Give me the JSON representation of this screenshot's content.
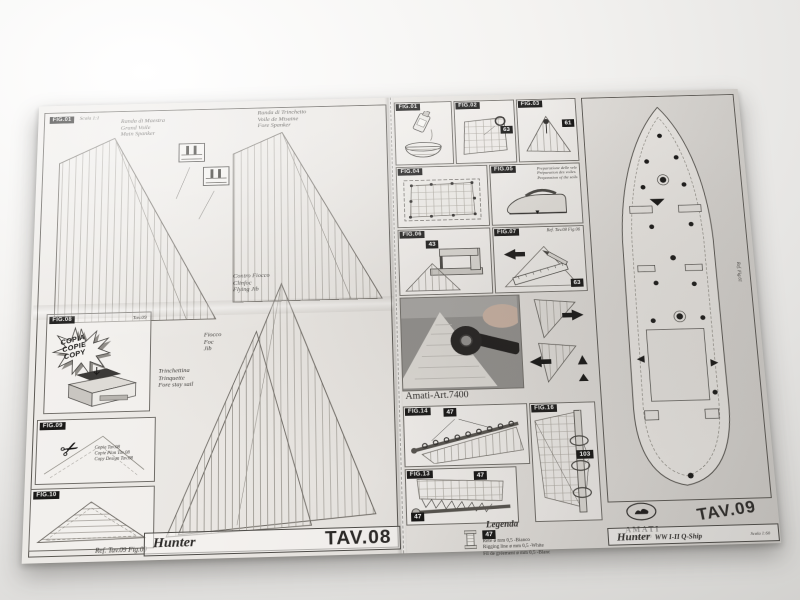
{
  "icons": {
    "scissors": "✂",
    "arrow_down": "▼"
  },
  "tav08": {
    "corner_fig": "FIG.01",
    "corner_scale": "Scala 1:1",
    "main_spanker": [
      "Randa di Maestra",
      "Grand Voile",
      "Main Spanker"
    ],
    "fore_spanker": [
      "Randa di Trinchetto",
      "Voile de Misaine",
      "Fore Spanker"
    ],
    "flying_jib": [
      "Contro Fiocco",
      "Clinfoc",
      "Flying Jib"
    ],
    "jib": [
      "Fiocco",
      "Foc",
      "Jib"
    ],
    "fore_stay": [
      "Trinchettina",
      "Trinquette",
      "Fore stay sail"
    ],
    "copy_fig": "FIG.08",
    "copy_ref": "Tav.09",
    "burst": [
      "COPIA",
      "COPIE",
      "COPY"
    ],
    "cut_fig": "FIG.09",
    "cut_note": [
      "Copia Tav.08",
      "Copie Plan Tav.08",
      "Copy Design Tav.08"
    ],
    "hatch_fig": "FIG.10",
    "ref_note": "Ref. Tav.09 Fig.09",
    "title_name": "Hunter",
    "title_tav": "TAV.08"
  },
  "steps": {
    "p1_fig": "FIG.01",
    "p2_fig": "FIG.02",
    "p3_fig": "FIG.03",
    "p4_fig": "FIG.04",
    "p5_fig": "FIG.05",
    "p6_fig": "FIG.06",
    "p7_fig": "FIG.07",
    "p2_num": "63",
    "p3_num": "61",
    "p6_num": "43",
    "p7_num": "63",
    "p5_note": [
      "Preparazione delle vele",
      "Préparation des voiles",
      "Preparation of the sails"
    ],
    "p7_ref": "Ref. Tav.08 Fig.06",
    "photo_fig": "FIG.11",
    "photo_caption": "Amati-Art.7400"
  },
  "rig": {
    "fig14": "FIG.14",
    "fig14_num": "47",
    "fig16": "FIG.16",
    "fig16_num": "103",
    "fig13": "FIG.13",
    "fig13_num_a": "47",
    "fig13_num_b": "47",
    "legend_title": "Legenda",
    "legend_num": "47",
    "legend_lines": [
      "Refe ø mm 0,5 -Bianco",
      "Rigging line ø mm 0,5 -White",
      "Fil de gréement ø mm 0,5 -Blanc"
    ]
  },
  "tav09": {
    "deck_ref": "Ref. Fig.61",
    "brand": "AMATI",
    "art": "Art.1450",
    "tav": "TAV.09",
    "title_name": "Hunter",
    "title_sub": "WW I-II Q-Ship",
    "scale": "Scala 1:60"
  }
}
